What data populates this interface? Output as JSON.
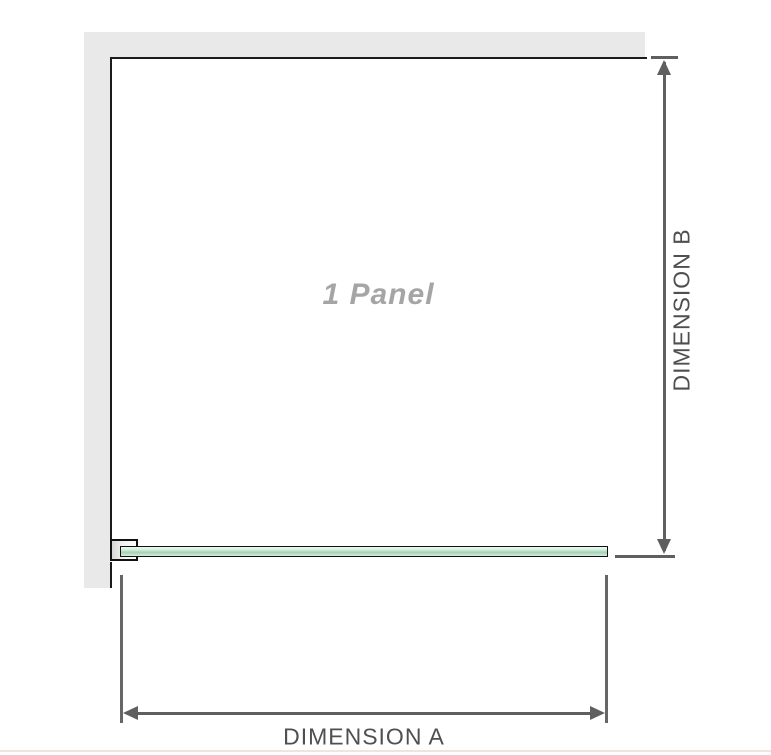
{
  "diagram": {
    "panel_label": "1 Panel",
    "dimension_a": {
      "label": "DIMENSION A"
    },
    "dimension_b": {
      "label": "DIMENSION B"
    }
  },
  "colors": {
    "wall_gray": "#e9e9e9",
    "frame_black": "#1b1b1b",
    "dimension_line_gray": "#5f5f5f",
    "label_gray": "#4f4f4f",
    "watermark_gray": "#a5a5a5",
    "glass_green_light": "#d8efdf",
    "glass_green_dark": "#a4d3b6",
    "bottom_separator": "#f0e4e1"
  }
}
